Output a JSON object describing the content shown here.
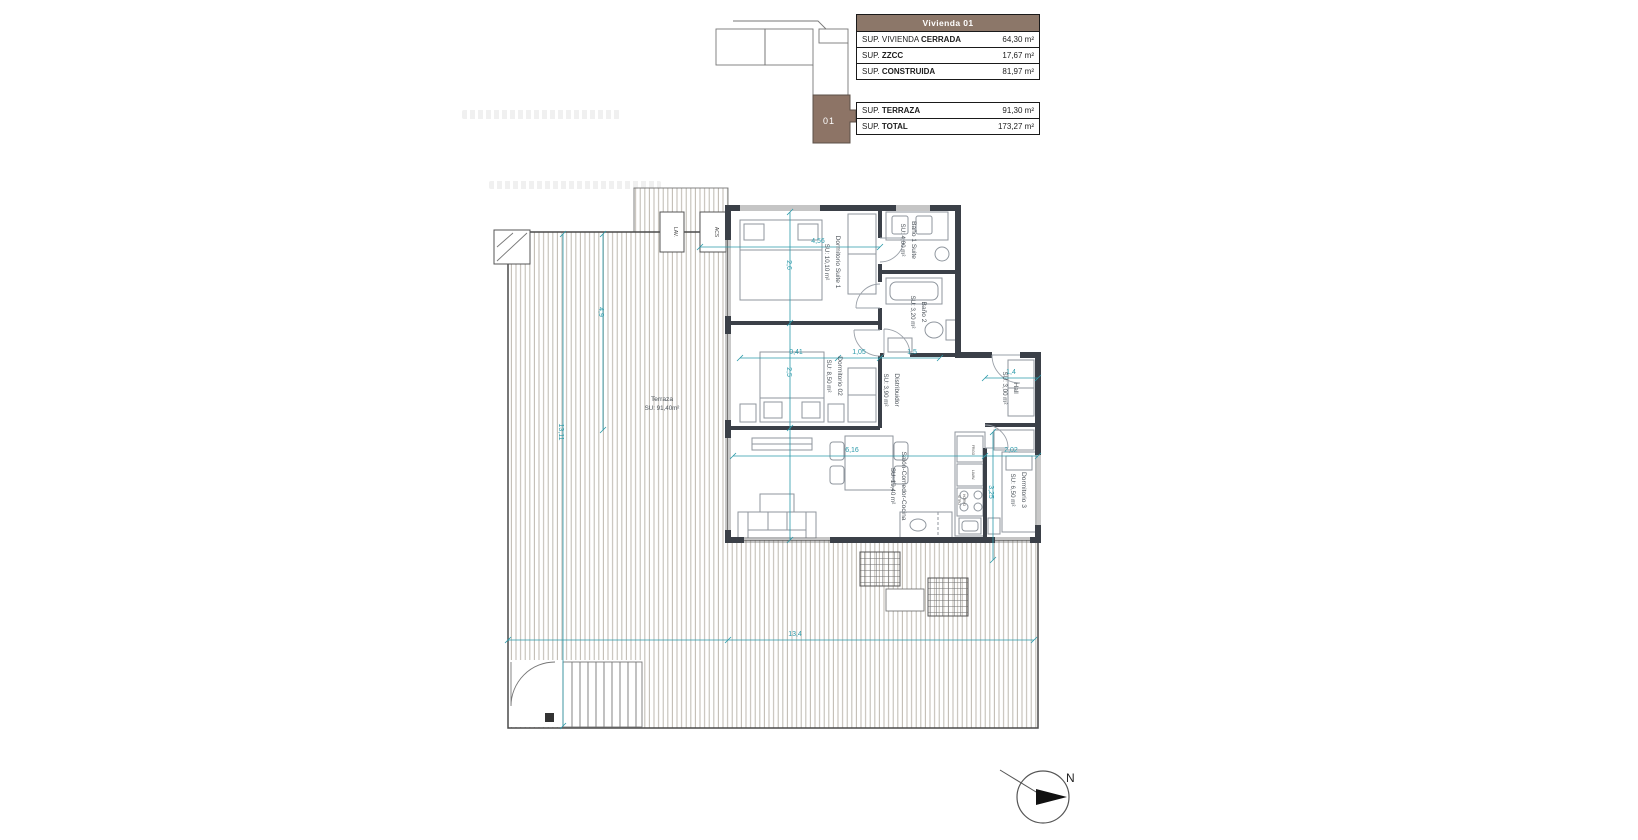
{
  "keyplan": {
    "unit": "01"
  },
  "tables": {
    "header": "Vivienda 01",
    "t1": [
      {
        "pre": "SUP. VIVIENDA ",
        "bold": "CERRADA",
        "value": "64,30 m²"
      },
      {
        "pre": "SUP. ",
        "bold": "ZZCC",
        "value": "17,67 m²"
      },
      {
        "pre": "SUP. ",
        "bold": "CONSTRUIDA",
        "value": "81,97 m²"
      }
    ],
    "t2": [
      {
        "pre": "SUP. ",
        "bold": "TERRAZA",
        "value": "91,30 m²"
      },
      {
        "pre": "SUP. ",
        "bold": "TOTAL",
        "value": "173,27 m²"
      }
    ]
  },
  "rooms": {
    "suite1": {
      "name": "Dormitorio Suite 1",
      "area": "SU: 10,10 m²"
    },
    "bano1": {
      "name": "Baño 1 Suite",
      "area": "SU: 4,00 m²"
    },
    "bano2": {
      "name": "Baño 2",
      "area": "SU: 3,20 m²"
    },
    "dorm2": {
      "name": "Dormitorio 02",
      "area": "SU: 8,50 m²"
    },
    "distribuidor": {
      "name": "Distribuidor",
      "area": "SU: 3,90 m²"
    },
    "hall": {
      "name": "Hall",
      "area": "SU: 3,00 m²"
    },
    "dorm3": {
      "name": "Dormitorio 3",
      "area": "SU: 6,50 m²"
    },
    "salon": {
      "name": "Salón-Comedor-Cocina",
      "area": "SU: 19,40 m²"
    },
    "terraza": {
      "name": "Terraza",
      "area": "SU: 91,40m²"
    }
  },
  "dims": {
    "suite_w": "4,56",
    "suite_h": "2,6",
    "dorm2_h": "2,5",
    "seg_a": "0,41",
    "seg_b": "1,05",
    "seg_c": "1,5",
    "hall_w": "1,4",
    "salon_w": "6,16",
    "dorm3_w": "2,02",
    "kitchen_h": "3,25",
    "terr_col_h": "4,9",
    "total_h": "13,11",
    "total_w": "13,4"
  },
  "utility": {
    "acs": "ACS",
    "lav": "LAV."
  },
  "kitchen": {
    "frigo": "FRIGO",
    "lavav": "LAVAV.",
    "vitro": "VITRO",
    "horno": "HORNO"
  },
  "compass": {
    "north": "N"
  },
  "colors": {
    "accent_brown": "#8c7769",
    "dim_teal": "#2b9aaa",
    "wall": "#3b4048"
  }
}
